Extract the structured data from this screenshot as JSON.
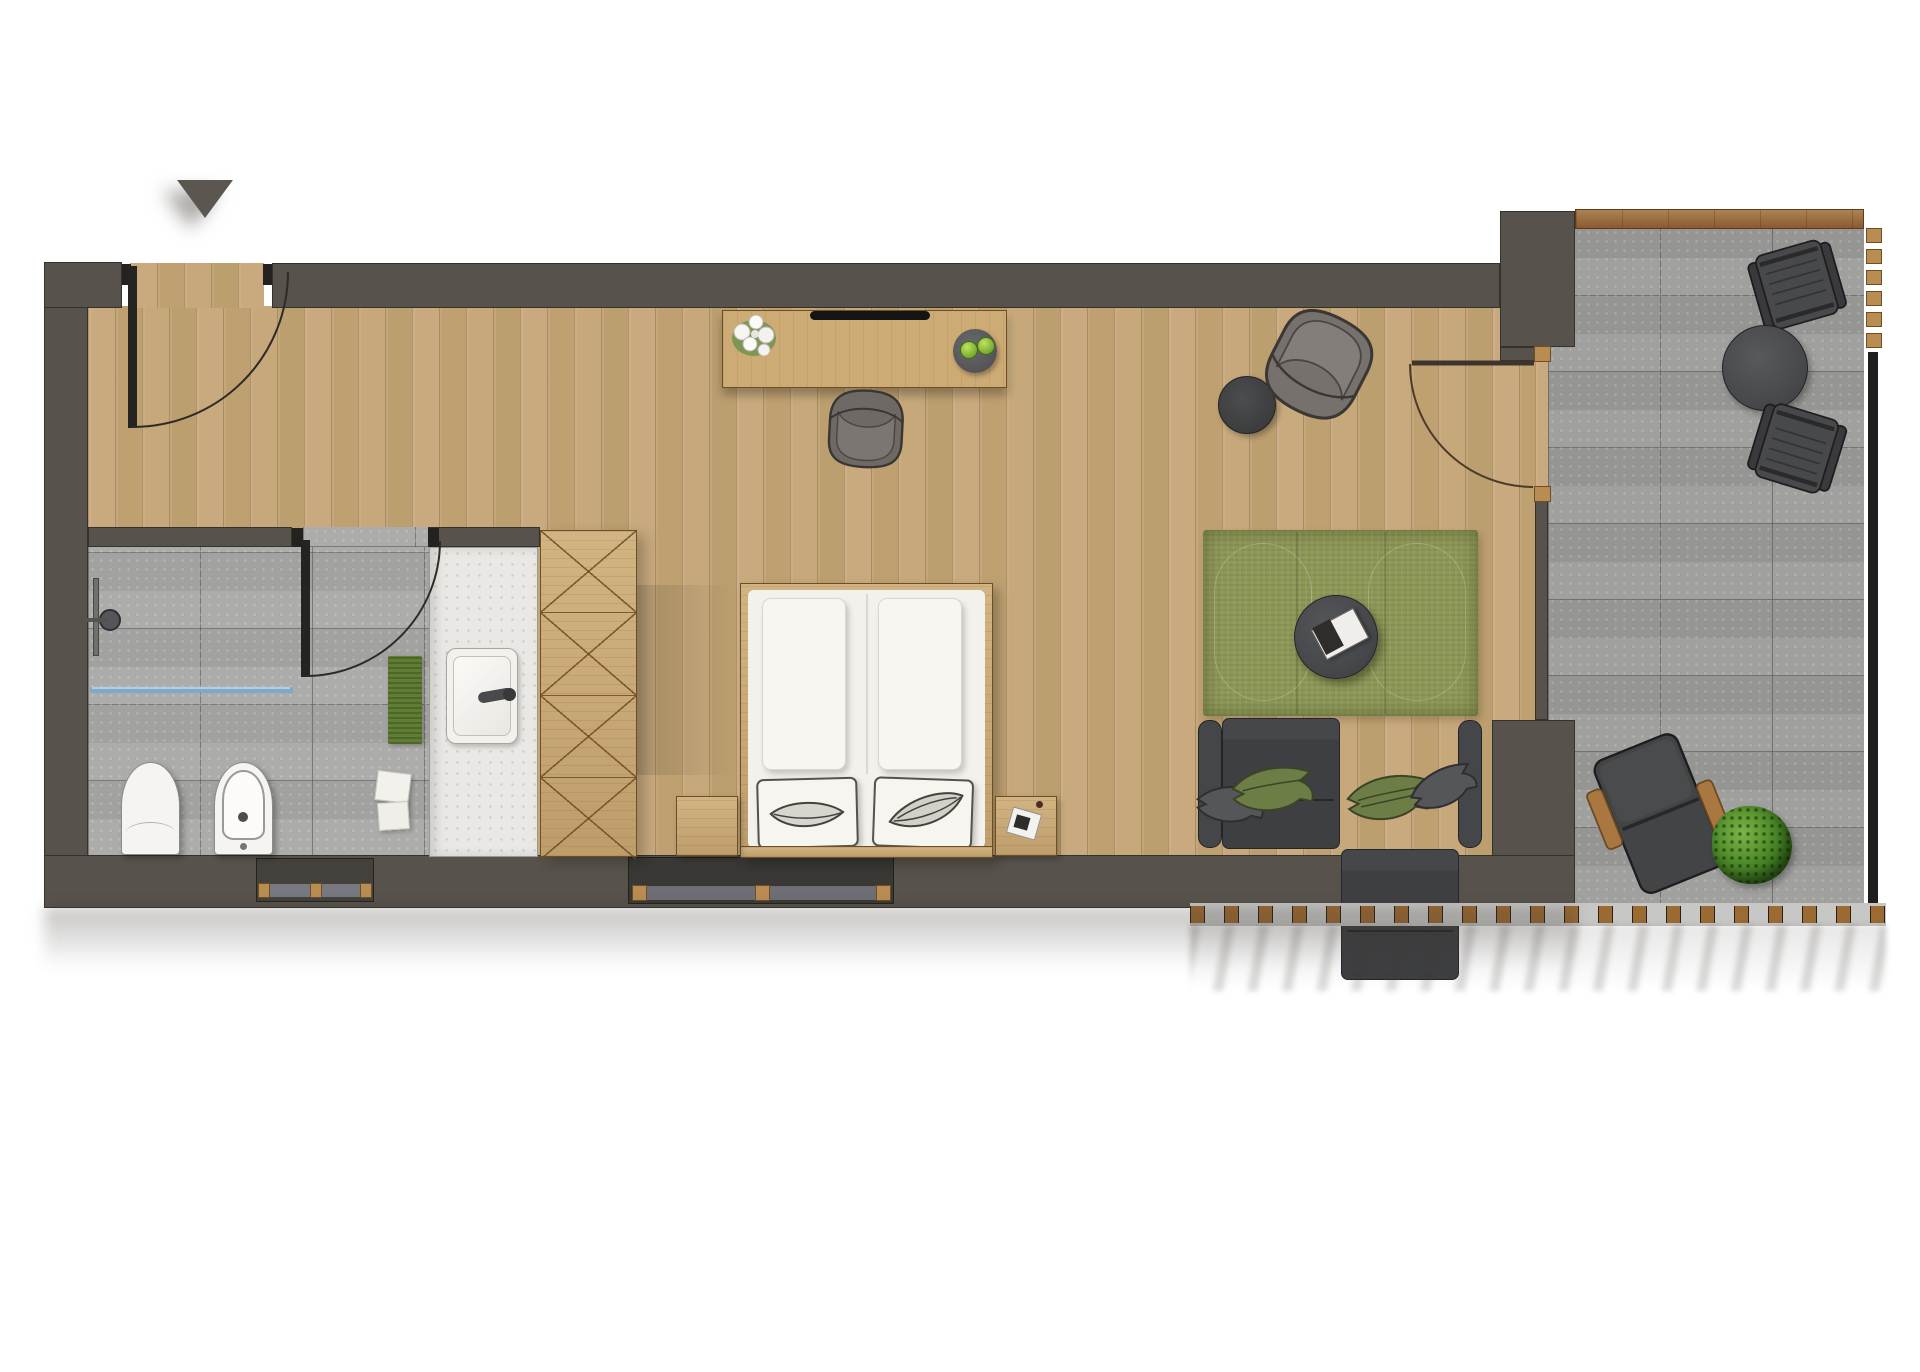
{
  "meta": {
    "title": "Hotel suite floor plan, top view",
    "type": "architectural-floor-plan",
    "orientation_marker": "entrance-triangle"
  },
  "palette": {
    "wall": "#57524B",
    "wood_floor": "#C4A478",
    "furniture_wood": "#CDAB74",
    "bathroom_tile": "#A8A8A6",
    "terrace_stone": "#A0A09E",
    "rug_green": "#8D9756",
    "textile_green": "#6C7D45",
    "sofa_charcoal": "#3F4043",
    "glass_blue": "#7FA9CB",
    "fixture_white": "#F5F4F0",
    "outdoor_wood": "#A9773F",
    "door_panel": "#262421"
  },
  "rooms": [
    {
      "id": "entry",
      "label": "Entry",
      "features": [
        "entry-door",
        "door-swing-arc",
        "north-entrance-marker"
      ]
    },
    {
      "id": "bathroom",
      "label": "Bathroom",
      "features": [
        "shower-head",
        "shower-rail",
        "glass-partition",
        "bath-mat",
        "toilet",
        "bidet",
        "towel-stack",
        "vanity-counter",
        "sink",
        "faucet",
        "bathroom-door"
      ]
    },
    {
      "id": "bedroom",
      "label": "Bedroom",
      "features": [
        "wardrobe-4-sections",
        "double-bed",
        "duvet-left",
        "duvet-right",
        "pillow-left",
        "pillow-right",
        "nightstand-left",
        "nightstand-right",
        "notepad",
        "window-recess"
      ]
    },
    {
      "id": "study-corner",
      "label": "Desk corner",
      "features": [
        "desk",
        "tv-soundbar",
        "flower-vase",
        "fruit-plate-with-apples",
        "desk-chair"
      ]
    },
    {
      "id": "living",
      "label": "Living area",
      "features": [
        "armchair",
        "side-table",
        "green-rug",
        "coffee-table",
        "magazine",
        "sofa-two-seater",
        "leaf-cushions",
        "terrace-door"
      ]
    },
    {
      "id": "terrace",
      "label": "Terrace",
      "features": [
        "stone-tiles",
        "wood-edge-plank",
        "outdoor-chair-upper",
        "outdoor-round-table",
        "outdoor-chair-lower",
        "lounge-chair",
        "potted-plant",
        "balustrade-posts",
        "railing"
      ]
    }
  ]
}
